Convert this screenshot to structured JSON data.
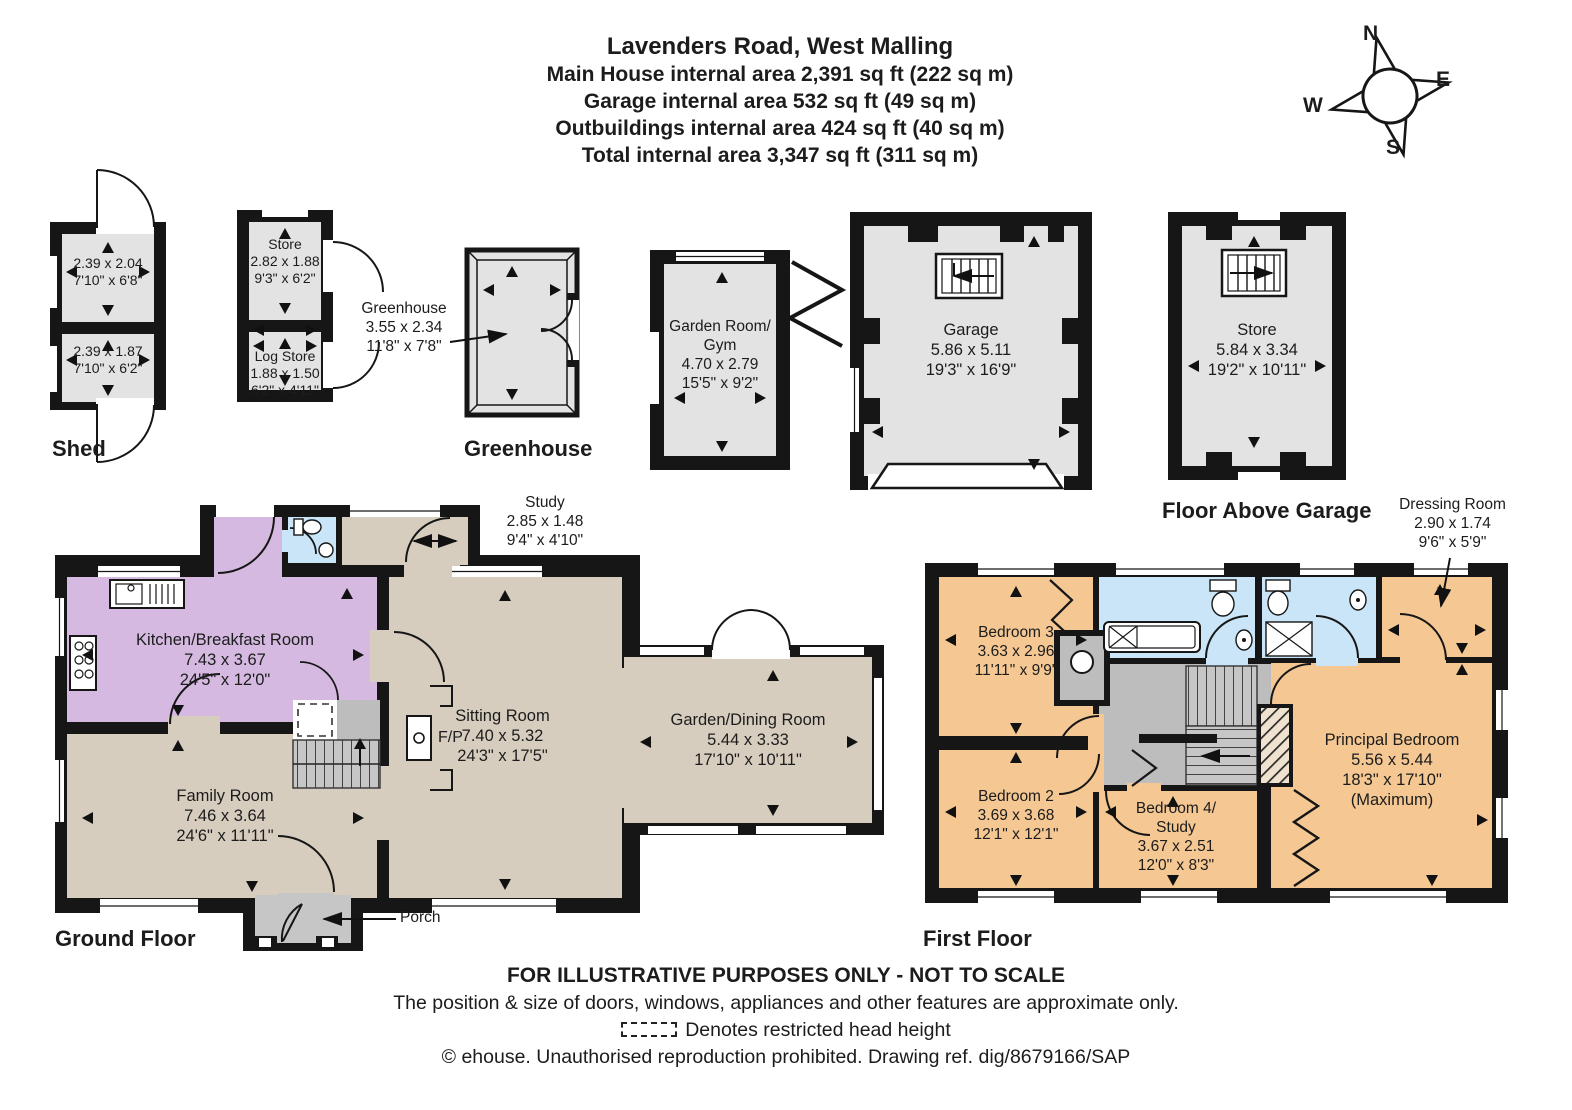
{
  "title": {
    "address": "Lavenders Road, West Malling",
    "main_house": "Main House internal area 2,391 sq ft (222 sq m)",
    "garage": "Garage internal area 532 sq ft (49 sq m)",
    "outbuildings": "Outbuildings internal area 424 sq ft (40 sq m)",
    "total": "Total internal area 3,347 sq ft (311 sq m)"
  },
  "compass": {
    "north": "N",
    "east": "E",
    "south": "S",
    "west": "W"
  },
  "outbuildings": {
    "shed": {
      "label": "Shed",
      "top_room": {
        "metric": "2.39 x 2.04",
        "imperial": "7'10\" x 6'8\""
      },
      "bottom_room": {
        "metric": "2.39 x 1.87",
        "imperial": "7'10\" x 6'2\""
      }
    },
    "store": {
      "name": "Store",
      "metric": "2.82 x 1.88",
      "imperial": "9'3\" x 6'2\""
    },
    "log_store": {
      "name": "Log Store",
      "metric": "1.88 x 1.50",
      "imperial": "6'2\" x 4'11\""
    },
    "greenhouse": {
      "label": "Greenhouse",
      "name": "Greenhouse",
      "metric": "3.55 x 2.34",
      "imperial": "11'8\" x 7'8\""
    },
    "garden_room": {
      "name_lines": [
        "Garden Room/",
        "Gym"
      ],
      "metric": "4.70 x 2.79",
      "imperial": "15'5\" x 9'2\""
    },
    "garage": {
      "name": "Garage",
      "metric": "5.86 x 5.11",
      "imperial": "19'3\" x 16'9\""
    },
    "store_above_garage": {
      "label": "Floor Above Garage",
      "name": "Store",
      "metric": "5.84 x 3.34",
      "imperial": "19'2\" x 10'11\""
    }
  },
  "ground_floor": {
    "label": "Ground Floor",
    "study": {
      "name": "Study",
      "metric": "2.85 x 1.48",
      "imperial": "9'4\" x 4'10\""
    },
    "kitchen": {
      "name": "Kitchen/Breakfast Room",
      "metric": "7.43 x 3.67",
      "imperial": "24'5\" x 12'0\""
    },
    "family_room": {
      "name": "Family Room",
      "metric": "7.46 x 3.64",
      "imperial": "24'6\" x 11'11\""
    },
    "sitting_room": {
      "name": "Sitting Room",
      "metric": "7.40 x 5.32",
      "imperial": "24'3\" x 17'5\""
    },
    "garden_dining": {
      "name": "Garden/Dining Room",
      "metric": "5.44 x 3.33",
      "imperial": "17'10\" x 10'11\""
    },
    "fireplace": "F/P",
    "porch": "Porch"
  },
  "first_floor": {
    "label": "First Floor",
    "bedroom3": {
      "name": "Bedroom 3",
      "metric": "3.63 x 2.96",
      "imperial": "11'11\" x 9'9\""
    },
    "bedroom2": {
      "name": "Bedroom 2",
      "metric": "3.69 x 3.68",
      "imperial": "12'1\" x 12'1\""
    },
    "bedroom4": {
      "name_lines": [
        "Bedroom 4/",
        "Study"
      ],
      "metric": "3.67 x 2.51",
      "imperial": "12'0\" x 8'3\""
    },
    "principal": {
      "name": "Principal Bedroom",
      "metric": "5.56 x 5.44",
      "imperial": "18'3\" x 17'10\"",
      "note": "(Maximum)"
    },
    "dressing": {
      "name": "Dressing Room",
      "metric": "2.90 x 1.74",
      "imperial": "9'6\" x 5'9\""
    }
  },
  "footer": {
    "line1": "FOR ILLUSTRATIVE PURPOSES ONLY - NOT TO SCALE",
    "line2": "The position & size of doors, windows, appliances and other features are approximate only.",
    "line3": "Denotes restricted head height",
    "line4": "© ehouse. Unauthorised reproduction prohibited. Drawing ref. dig/8679166/SAP"
  },
  "colors": {
    "wall": "#161616",
    "outbuilding_fill": "#e3e3e3",
    "tan": "#d7cdbf",
    "purple": "#d5b9e0",
    "blue": "#c9e5f7",
    "orange": "#f4c793",
    "landing_gray": "#bdbdbd",
    "porch_gray": "#c6c6c6"
  }
}
